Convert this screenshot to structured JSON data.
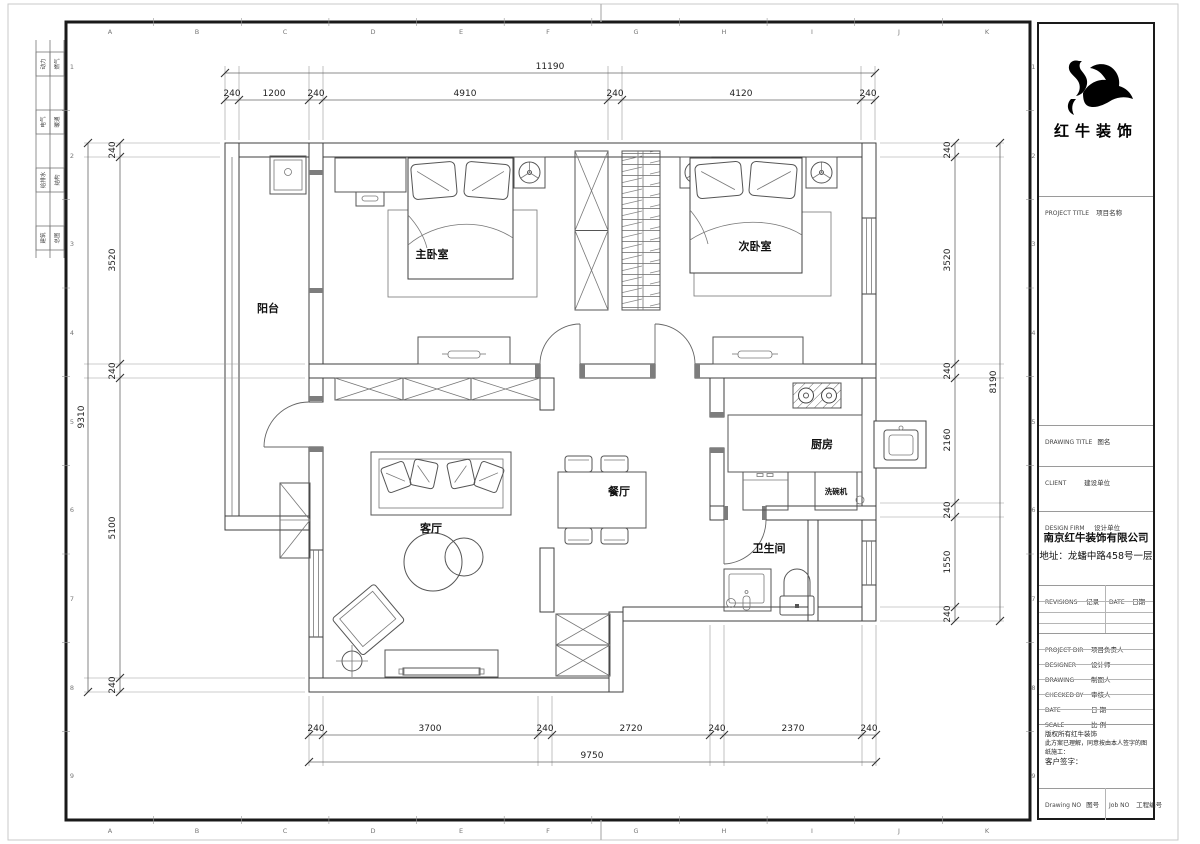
{
  "sheet": {
    "grid_letters": [
      "A",
      "B",
      "C",
      "D",
      "E",
      "F",
      "G",
      "H",
      "I",
      "J",
      "K"
    ],
    "grid_numbers": [
      "1",
      "2",
      "3",
      "4",
      "5",
      "6",
      "7",
      "8",
      "9"
    ],
    "stamps": [
      {
        "left": "动力",
        "right": "燃气"
      },
      {
        "left": "电气",
        "right": "暖通"
      },
      {
        "left": "给排水",
        "right": "结构"
      },
      {
        "left": "建筑",
        "right": "总图"
      }
    ]
  },
  "plan": {
    "labels": {
      "balcony": "阳台",
      "master_bedroom": "主卧室",
      "second_bedroom": "次卧室",
      "living_room": "客厅",
      "dining_room": "餐厅",
      "kitchen": "厨房",
      "bathroom": "卫生间",
      "dishwasher": "洗碗机"
    },
    "dims": {
      "top_total": "11190",
      "top_segments": [
        "240",
        "1200",
        "240",
        "4910",
        "240",
        "4120",
        "240"
      ],
      "bottom_total": "9750",
      "bottom_segments": [
        "240",
        "3700",
        "240",
        "2720",
        "240",
        "2370",
        "240"
      ],
      "left_total": "9310",
      "left_segments": [
        "240",
        "3520",
        "240",
        "5100",
        "240"
      ],
      "right_total": "8190",
      "right_segments": [
        "240",
        "3520",
        "240",
        "2160",
        "240",
        "1550",
        "240"
      ]
    }
  },
  "titleblock": {
    "logo_text": "红牛装饰",
    "project_title_en": "PROJECT TITLE",
    "project_title_cn": "项目名称",
    "drawing_title_en": "DRAWING TITLE",
    "drawing_title_cn": "图名",
    "client_en": "CLIENT",
    "client_cn": "建设单位",
    "design_firm_en": "DESIGN FIRM",
    "design_firm_cn": "设计单位",
    "company": "南京红牛装饰有限公司",
    "address": "地址：龙蟠中路458号一层",
    "revisions_en": "REVISIONS",
    "revisions_cn": "记录",
    "date_hdr_en": "DATE",
    "date_hdr_cn": "日期",
    "rows": [
      {
        "en": "PROJECT DIR",
        "cn": "项目负责人"
      },
      {
        "en": "DESIGNER",
        "cn": "设计师"
      },
      {
        "en": "DRAWING",
        "cn": "制图人"
      },
      {
        "en": "CHECKED BY",
        "cn": "审核人"
      },
      {
        "en": "DATE",
        "cn": "日  期"
      },
      {
        "en": "SCALE",
        "cn": "比  例"
      }
    ],
    "copyright": "版权所有红牛装饰",
    "agreement": "此方案已理解，同意按由本人签字的图纸施工：",
    "signature": "客户签字：",
    "drawing_no_en": "Drawing NO",
    "drawing_no_cn": "图号",
    "job_no_en": "Job NO",
    "job_no_cn": "工程编号"
  }
}
